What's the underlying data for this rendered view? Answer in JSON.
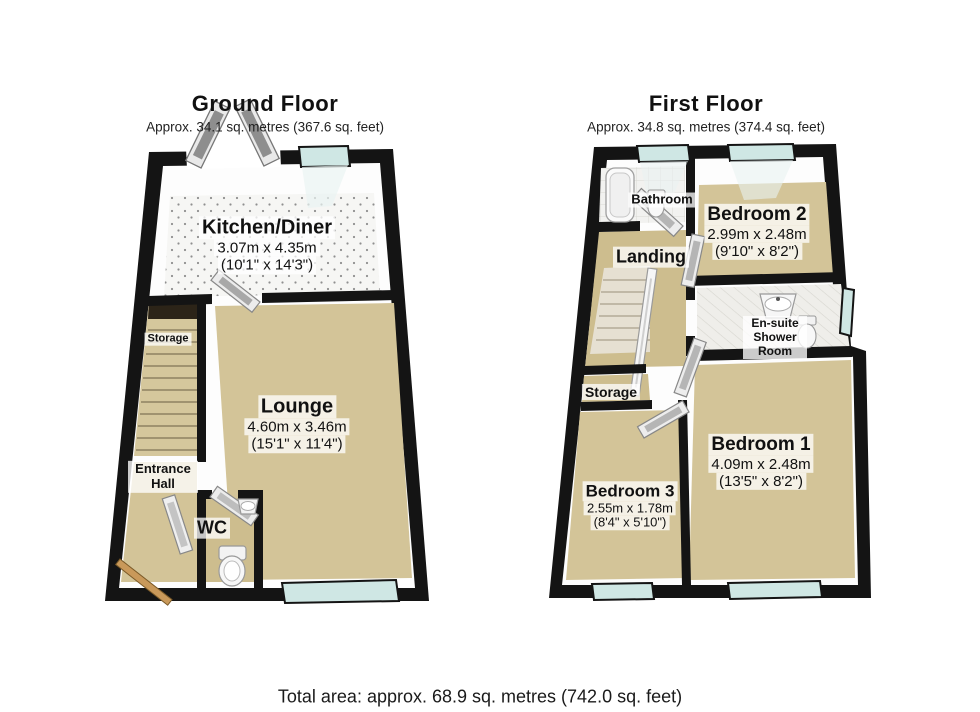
{
  "footer": {
    "total_area": "Total area: approx. 68.9 sq. metres (742.0 sq. feet)"
  },
  "colors": {
    "wall": "#141414",
    "wall_face": "#fdfdfd",
    "carpet": "#d3c498",
    "carpet_dark": "#cdbd8e",
    "window_glass": "#cfe7e4",
    "window_reflection": "#e9f3f2",
    "door_wood": "#c9995a",
    "fixture": "#f5f5f5"
  },
  "ground_floor": {
    "title": "Ground Floor",
    "subtitle": "Approx. 34.1 sq. metres (367.6 sq. feet)",
    "rooms": [
      {
        "name": "Kitchen/Diner",
        "metric": "3.07m x 4.35m",
        "imperial": "(10'1\" x 14'3\")"
      },
      {
        "name": "Storage"
      },
      {
        "name": "Lounge",
        "metric": "4.60m x 3.46m",
        "imperial": "(15'1\" x 11'4\")"
      },
      {
        "name": "Entrance Hall"
      },
      {
        "name": "WC"
      }
    ]
  },
  "first_floor": {
    "title": "First Floor",
    "subtitle": "Approx. 34.8 sq. metres (374.4 sq. feet)",
    "rooms": [
      {
        "name": "Bathroom"
      },
      {
        "name": "Bedroom 2",
        "metric": "2.99m x 2.48m",
        "imperial": "(9'10\" x 8'2\")"
      },
      {
        "name": "Landing"
      },
      {
        "name": "En-suite Shower Room"
      },
      {
        "name": "Storage"
      },
      {
        "name": "Bedroom 3",
        "metric": "2.55m x 1.78m",
        "imperial": "(8'4\" x 5'10\")"
      },
      {
        "name": "Bedroom 1",
        "metric": "4.09m x 2.48m",
        "imperial": "(13'5\" x 8'2\")"
      }
    ]
  }
}
